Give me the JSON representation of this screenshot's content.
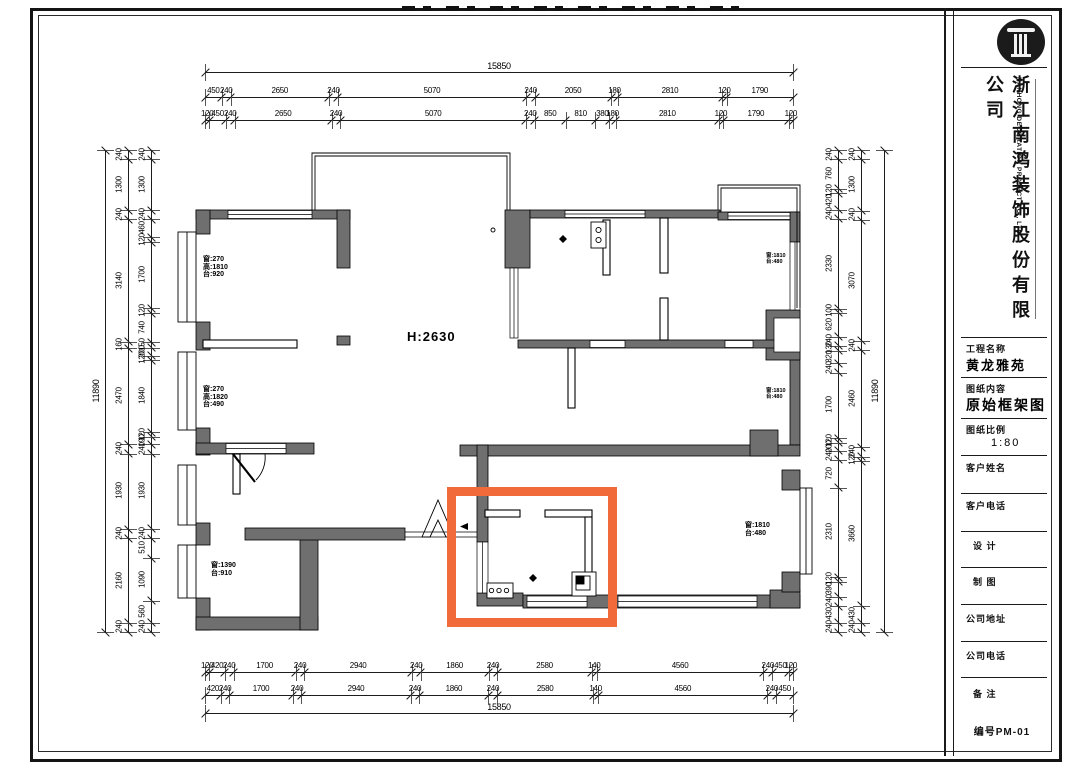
{
  "title_block": {
    "company_cn": "浙江南鸿装饰股份有限公司",
    "company_en": "NANHONG DECORATION PROJECT CO., LTD.",
    "fields": [
      {
        "label": "工程名称",
        "value": "黄龙雅苑"
      },
      {
        "label": "图纸内容",
        "value": "原始框架图"
      },
      {
        "label": "图纸比例",
        "value": "1:80"
      },
      {
        "label": "客户姓名",
        "value": ""
      },
      {
        "label": "客户电话",
        "value": ""
      },
      {
        "label": "设  计",
        "value": ""
      },
      {
        "label": "制  图",
        "value": ""
      },
      {
        "label": "公司地址",
        "value": ""
      },
      {
        "label": "公司电话",
        "value": ""
      },
      {
        "label": "备  注",
        "value": ""
      }
    ],
    "sheet_no": "编号PM-01"
  },
  "plan": {
    "height_label": "H:2630",
    "highlight_color": "#f06b39",
    "window_labels": [
      {
        "lines": [
          "窗:270",
          "高:1810",
          "台:920"
        ]
      },
      {
        "lines": [
          "窗:270",
          "高:1820",
          "台:490"
        ]
      },
      {
        "lines": [
          "窗:1390",
          "台:910"
        ]
      },
      {
        "lines": [
          "窗:1810",
          "台:480"
        ]
      },
      {
        "lines": [
          "窗:1810",
          "台:480"
        ]
      },
      {
        "lines": [
          "窗:1810",
          "台:480"
        ]
      }
    ]
  },
  "dimensions": {
    "top": {
      "overall": [
        "15850"
      ],
      "row2": [
        "450",
        "240",
        "2650",
        "240",
        "5070",
        "240",
        "2050",
        "180",
        "2810",
        "120",
        "1790"
      ],
      "row3": [
        "120",
        "450",
        "240",
        "2650",
        "240",
        "5070",
        "240",
        "850",
        "810",
        "380",
        "180",
        "2810",
        "120",
        "1790",
        "120"
      ]
    },
    "bottom": {
      "row1": [
        "120",
        "420",
        "240",
        "1700",
        "240",
        "2940",
        "240",
        "1860",
        "240",
        "2580",
        "140",
        "4560",
        "240",
        "450",
        "120"
      ],
      "row2": [
        "420",
        "240",
        "1700",
        "240",
        "2940",
        "240",
        "1860",
        "240",
        "2580",
        "140",
        "4560",
        "240",
        "450"
      ],
      "overall": [
        "15850"
      ]
    },
    "left": {
      "outer": [
        "11890"
      ],
      "mid": [
        "240",
        "1300",
        "240",
        "3140",
        "160",
        "2470",
        "240",
        "1930",
        "240",
        "2160",
        "240"
      ],
      "inner": [
        "240",
        "1300",
        "240",
        "460",
        "120",
        "1700",
        "120",
        "740",
        "150",
        "200",
        "120",
        "1840",
        "120",
        "190",
        "240",
        "1930",
        "240",
        "510",
        "1090",
        "560",
        "240"
      ]
    },
    "right": {
      "inner": [
        "240",
        "760",
        "120",
        "420",
        "240",
        "2330",
        "100",
        "620",
        "240",
        "130",
        "320",
        "240",
        "1700",
        "120",
        "200",
        "240",
        "720",
        "2310",
        "120",
        "390",
        "240",
        "430",
        "240"
      ],
      "mid": [
        "240",
        "1300",
        "240",
        "3070",
        "240",
        "2460",
        "240",
        "120",
        "3660",
        "430",
        "240"
      ],
      "outer": [
        "11890"
      ]
    }
  }
}
